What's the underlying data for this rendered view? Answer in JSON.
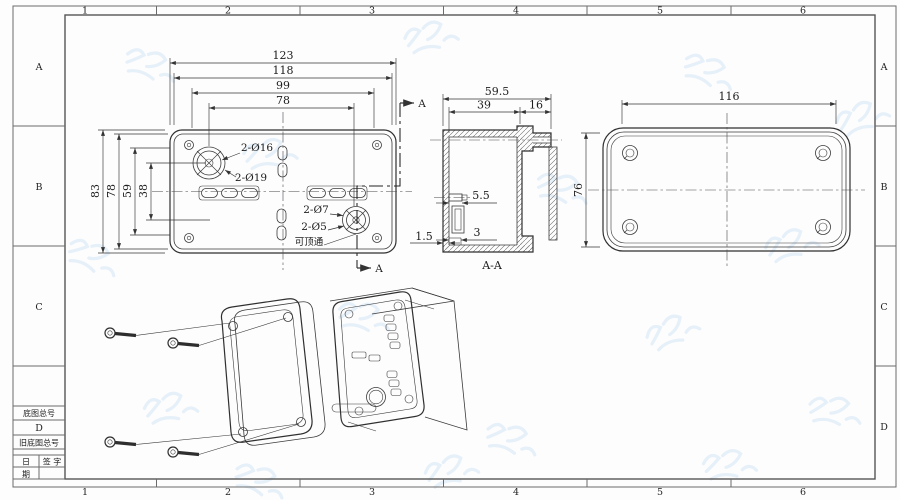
{
  "colors": {
    "line": "#3a3a3a",
    "frame": "#6b6b6b",
    "watermark": "#cfe2f4"
  },
  "sheet": {
    "top_zones": [
      "1",
      "2",
      "3",
      "4",
      "5",
      "6"
    ],
    "bottom_zones": [
      "1",
      "2",
      "3",
      "4",
      "5",
      "6"
    ],
    "left_zones": [
      "A",
      "B",
      "C"
    ],
    "right_zones": [
      "A",
      "B",
      "C",
      "D"
    ]
  },
  "title_block": {
    "zone_d": "D",
    "base_no_label": "底图总号",
    "old_base_no_label": "旧底图总号",
    "date_top": "日",
    "date_bottom": "期",
    "sign_label": "签 字"
  },
  "back_view": {
    "dim_123": "123",
    "dim_118": "118",
    "dim_99": "99",
    "dim_78_top": "78",
    "dim_83": "83",
    "dim_78_left": "78",
    "dim_59": "59",
    "dim_38": "38",
    "callout_16": "2-Ø16",
    "callout_19": "2-Ø19",
    "callout_7": "2-Ø7",
    "callout_5": "2-Ø5",
    "callout_note": "可顶通",
    "section_label": "A"
  },
  "section_view": {
    "title": "A-A",
    "dim_total_depth": "59.5",
    "dim_39": "39",
    "dim_16": "16",
    "dim_5_5": "5.5",
    "dim_3": "3",
    "dim_1_5": "1.5"
  },
  "lid_view": {
    "dim_width": "116",
    "dim_height": "76"
  }
}
